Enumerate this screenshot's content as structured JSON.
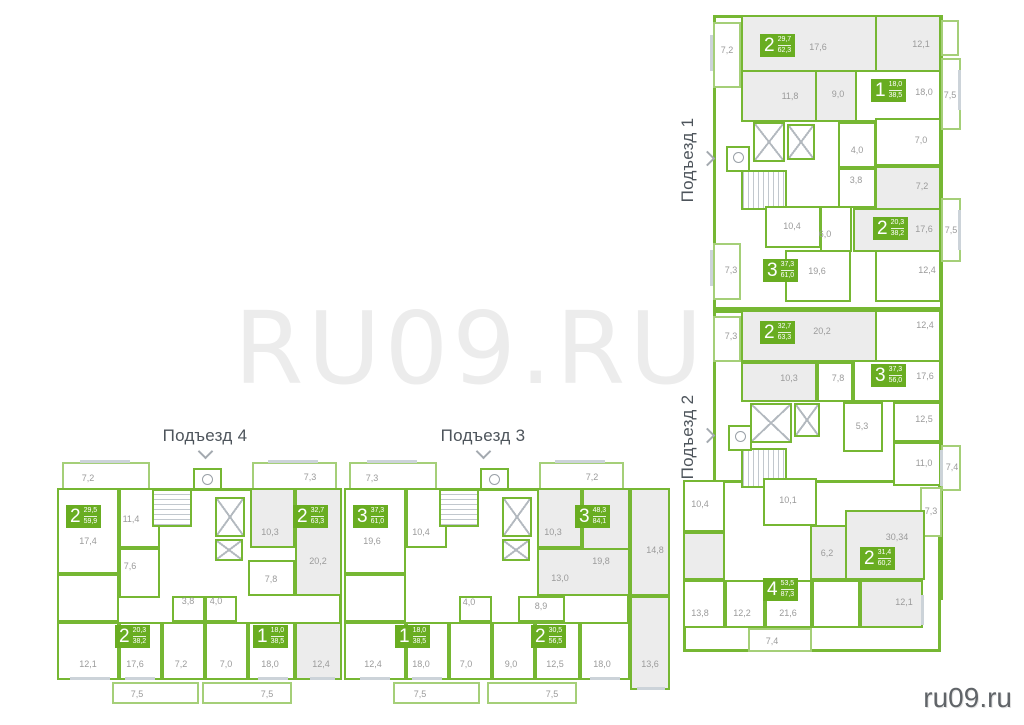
{
  "watermark": "RU09.RU",
  "site_logo": "ru09.ru",
  "colors": {
    "wall_green": "#76b733",
    "badge_green": "#69ad21",
    "room_highlight": "#ececec",
    "dim_text": "#9b9b9b",
    "title_text": "#4d545b"
  },
  "entrances": [
    {
      "name": "Подъезд 1",
      "apartments": [
        {
          "rooms": "2",
          "area_living": "29,7",
          "area_total": "62,3"
        },
        {
          "rooms": "1",
          "area_living": "18,0",
          "area_total": "38,5"
        },
        {
          "rooms": "2",
          "area_living": "20,3",
          "area_total": "38,2"
        },
        {
          "rooms": "3",
          "area_living": "37,3",
          "area_total": "61,0"
        }
      ],
      "rooms": [
        "7,2",
        "17,6",
        "12,1",
        "11,8",
        "9,0",
        "18,0",
        "7,5",
        "7,0",
        "4,0",
        "3,8",
        "7,2",
        "10,4",
        "6,0",
        "17,6",
        "7,5",
        "7,3",
        "19,6",
        "12,4"
      ]
    },
    {
      "name": "Подъезд 2",
      "apartments": [
        {
          "rooms": "2",
          "area_living": "32,7",
          "area_total": "63,3"
        },
        {
          "rooms": "3",
          "area_living": "37,3",
          "area_total": "56,0"
        },
        {
          "rooms": "2",
          "area_living": "31,4",
          "area_total": "60,2"
        },
        {
          "rooms": "4",
          "area_living": "53,5",
          "area_total": "87,3"
        }
      ],
      "rooms": [
        "7,3",
        "20,2",
        "12,4",
        "10,3",
        "7,8",
        "17,6",
        "12,5",
        "5,3",
        "11,0",
        "7,4",
        "10,4",
        "10,1",
        "7,3",
        "30,34",
        "6,2",
        "13,8",
        "12,2",
        "21,6",
        "12,1",
        "7,4"
      ]
    },
    {
      "name": "Подъезд 3",
      "apartments": [
        {
          "rooms": "3",
          "area_living": "37,3",
          "area_total": "61,0"
        },
        {
          "rooms": "3",
          "area_living": "48,3",
          "area_total": "84,1"
        },
        {
          "rooms": "1",
          "area_living": "18,0",
          "area_total": "38,5"
        },
        {
          "rooms": "2",
          "area_living": "30,5",
          "area_total": "56,5"
        }
      ],
      "rooms": [
        "7,3",
        "7,2",
        "10,4",
        "19,6",
        "10,3",
        "19,8",
        "14,8",
        "13,0",
        "4,0",
        "8,9",
        "12,4",
        "18,0",
        "7,0",
        "9,0",
        "12,5",
        "18,0",
        "13,6",
        "7,5",
        "7,5"
      ]
    },
    {
      "name": "Подъезд 4",
      "apartments": [
        {
          "rooms": "2",
          "area_living": "29,5",
          "area_total": "59,9"
        },
        {
          "rooms": "2",
          "area_living": "32,7",
          "area_total": "63,3"
        },
        {
          "rooms": "2",
          "area_living": "20,3",
          "area_total": "38,2"
        },
        {
          "rooms": "1",
          "area_living": "18,0",
          "area_total": "38,5"
        }
      ],
      "rooms": [
        "7,2",
        "7,3",
        "11,4",
        "17,4",
        "10,3",
        "20,2",
        "7,6",
        "7,8",
        "3,8",
        "4,0",
        "12,1",
        "17,6",
        "7,2",
        "7,0",
        "18,0",
        "12,4",
        "7,5",
        "7,5"
      ]
    }
  ]
}
